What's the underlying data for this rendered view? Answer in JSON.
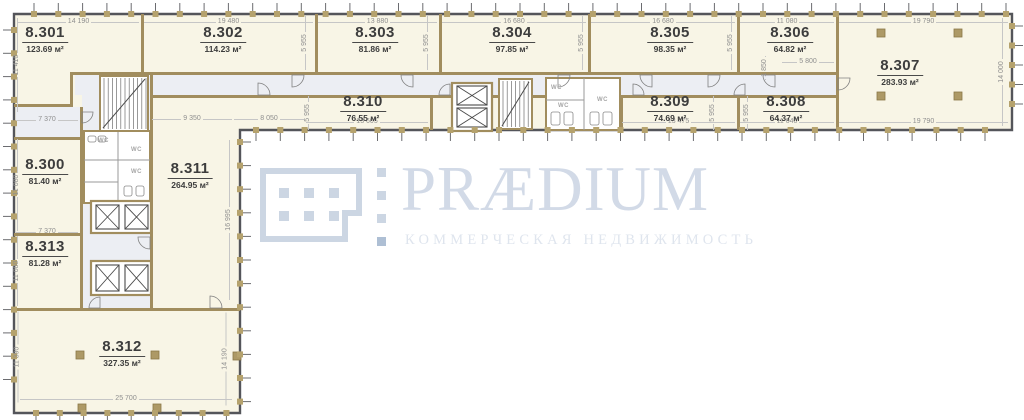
{
  "brand": {
    "name": "PRÆDIUM",
    "tagline": "КОММЕРЧЕСКАЯ НЕДВИЖИМОСТЬ"
  },
  "colors": {
    "room_fill": "#f8f5e6",
    "corridor_fill": "#eceef3",
    "wall": "#a18d5e",
    "tick_mark": "#b5a26d",
    "outline": "#54555a",
    "dim_text": "#8f8f8f",
    "label_text": "#3d3d3d",
    "wm_main": "#ccd6e3",
    "wm_text": "#d2dae7",
    "wm_sub": "#dfe5ee",
    "wm_accent": "#aebfd4"
  },
  "plan": {
    "unit": "м²",
    "wc_label": "WC",
    "rooms": [
      {
        "code": "8.301",
        "area": "123.69",
        "cx": 45,
        "cy": 24
      },
      {
        "code": "8.302",
        "area": "114.23",
        "cx": 223,
        "cy": 24
      },
      {
        "code": "8.303",
        "area": "81.86",
        "cx": 375,
        "cy": 24
      },
      {
        "code": "8.304",
        "area": "97.85",
        "cx": 512,
        "cy": 24
      },
      {
        "code": "8.305",
        "area": "98.35",
        "cx": 670,
        "cy": 24
      },
      {
        "code": "8.306",
        "area": "64.82",
        "cx": 790,
        "cy": 24
      },
      {
        "code": "8.307",
        "area": "283.93",
        "cx": 900,
        "cy": 57
      },
      {
        "code": "8.310",
        "area": "76.55",
        "cx": 363,
        "cy": 93
      },
      {
        "code": "8.309",
        "area": "74.69",
        "cx": 670,
        "cy": 93
      },
      {
        "code": "8.308",
        "area": "64.37",
        "cx": 786,
        "cy": 93
      },
      {
        "code": "8.300",
        "area": "81.40",
        "cx": 45,
        "cy": 156
      },
      {
        "code": "8.311",
        "area": "264.95",
        "cx": 190,
        "cy": 160
      },
      {
        "code": "8.313",
        "area": "81.28",
        "cx": 45,
        "cy": 238
      },
      {
        "code": "8.312",
        "area": "327.35",
        "cx": 122,
        "cy": 338
      }
    ],
    "dims_h": [
      {
        "t": "14 190",
        "x1": 18,
        "x2": 139,
        "y": 17
      },
      {
        "t": "19 480",
        "x1": 144,
        "x2": 313,
        "y": 17
      },
      {
        "t": "13 880",
        "x1": 318,
        "x2": 437,
        "y": 17
      },
      {
        "t": "16 680",
        "x1": 442,
        "x2": 586,
        "y": 17
      },
      {
        "t": "16 680",
        "x1": 591,
        "x2": 735,
        "y": 17
      },
      {
        "t": "11 080",
        "x1": 740,
        "x2": 834,
        "y": 17
      },
      {
        "t": "19 790",
        "x1": 839,
        "x2": 1008,
        "y": 17
      },
      {
        "t": "19 790",
        "x1": 839,
        "x2": 1008,
        "y": 117
      },
      {
        "t": "11 040",
        "x1": 740,
        "x2": 834,
        "y": 117
      },
      {
        "t": "13 475",
        "x1": 622,
        "x2": 735,
        "y": 117
      },
      {
        "t": "13 605",
        "x1": 306,
        "x2": 428,
        "y": 117
      },
      {
        "t": "8 050",
        "x1": 234,
        "x2": 304,
        "y": 114
      },
      {
        "t": "9 350",
        "x1": 152,
        "x2": 232,
        "y": 114
      },
      {
        "t": "5 800",
        "x1": 782,
        "x2": 834,
        "y": 57
      },
      {
        "t": "7 370",
        "x1": 16,
        "x2": 78,
        "y": 115
      },
      {
        "t": "7 370",
        "x1": 16,
        "x2": 78,
        "y": 227
      },
      {
        "t": "25 700",
        "x1": 20,
        "x2": 232,
        "y": 394
      }
    ],
    "dims_v": [
      {
        "t": "11 410",
        "x": 17,
        "y1": 18,
        "y2": 112
      },
      {
        "t": "11 080",
        "x": 17,
        "y1": 139,
        "y2": 231
      },
      {
        "t": "11 080",
        "x": 17,
        "y1": 236,
        "y2": 306
      },
      {
        "t": "11 390",
        "x": 17,
        "y1": 311,
        "y2": 402
      },
      {
        "t": "14 000",
        "x": 1002,
        "y1": 18,
        "y2": 126
      },
      {
        "t": "16 995",
        "x": 229,
        "y1": 140,
        "y2": 300
      },
      {
        "t": "14 190",
        "x": 225,
        "y1": 312,
        "y2": 405
      },
      {
        "t": "1 850",
        "x": 765,
        "y1": 56,
        "y2": 80
      },
      {
        "t": "5 955",
        "x": 305,
        "y1": 16,
        "y2": 70
      },
      {
        "t": "5 955",
        "x": 427,
        "y1": 16,
        "y2": 70
      },
      {
        "t": "5 955",
        "x": 582,
        "y1": 16,
        "y2": 70
      },
      {
        "t": "5 955",
        "x": 731,
        "y1": 16,
        "y2": 70
      },
      {
        "t": "5 955",
        "x": 308,
        "y1": 96,
        "y2": 130
      },
      {
        "t": "5 955",
        "x": 713,
        "y1": 96,
        "y2": 130
      },
      {
        "t": "5 955",
        "x": 747,
        "y1": 96,
        "y2": 130
      }
    ],
    "wc_labels": [
      {
        "x": 98,
        "y": 138
      },
      {
        "x": 131,
        "y": 147
      },
      {
        "x": 131,
        "y": 169
      },
      {
        "x": 551,
        "y": 85
      },
      {
        "x": 558,
        "y": 103
      },
      {
        "x": 597,
        "y": 97
      }
    ],
    "outline_path": "M14,14 H1012 V130 H240 V413 H14 Z",
    "corridors": [
      [
        75,
        75,
        761,
        20
      ],
      [
        82,
        72,
        70,
        238
      ],
      [
        16,
        107,
        66,
        30
      ]
    ],
    "walls": [
      [
        141,
        14,
        3,
        58
      ],
      [
        315,
        14,
        3,
        58
      ],
      [
        439,
        14,
        3,
        58
      ],
      [
        588,
        14,
        3,
        58
      ],
      [
        737,
        14,
        3,
        58
      ],
      [
        836,
        14,
        3,
        116
      ],
      [
        430,
        95,
        3,
        35
      ],
      [
        545,
        95,
        3,
        35
      ],
      [
        620,
        95,
        3,
        35
      ],
      [
        737,
        95,
        3,
        35
      ],
      [
        73,
        72,
        763,
        3
      ],
      [
        150,
        95,
        686,
        3
      ],
      [
        14,
        104,
        59,
        3
      ],
      [
        70,
        72,
        3,
        35
      ],
      [
        80,
        107,
        3,
        203
      ],
      [
        150,
        72,
        3,
        238
      ],
      [
        14,
        137,
        68,
        3
      ],
      [
        14,
        233,
        68,
        3
      ],
      [
        14,
        308,
        226,
        3
      ]
    ],
    "cores": [
      [
        546,
        78,
        74,
        52
      ],
      [
        84,
        131,
        66,
        72
      ]
    ],
    "stairs": [
      [
        100,
        76,
        48,
        55
      ],
      [
        499,
        79,
        33,
        50
      ]
    ],
    "elev_frames": [
      [
        91,
        201,
        60,
        32
      ],
      [
        91,
        261,
        60,
        34
      ],
      [
        452,
        83,
        40,
        48
      ]
    ],
    "elev_cabs": [
      [
        96,
        205,
        23,
        24
      ],
      [
        125,
        205,
        23,
        24
      ],
      [
        96,
        265,
        23,
        26
      ],
      [
        125,
        265,
        23,
        26
      ],
      [
        457,
        86,
        30,
        19
      ],
      [
        457,
        108,
        30,
        19
      ]
    ],
    "partitions": [
      [
        84,
        160,
        150,
        160
      ],
      [
        84,
        182,
        118,
        182
      ],
      [
        118,
        131,
        118,
        203
      ],
      [
        584,
        78,
        584,
        130
      ],
      [
        546,
        100,
        584,
        100
      ]
    ],
    "fixtures": [
      [
        551,
        112,
        9,
        13
      ],
      [
        564,
        112,
        9,
        13
      ],
      [
        590,
        112,
        9,
        13
      ],
      [
        603,
        112,
        9,
        13
      ],
      [
        88,
        136,
        8,
        6
      ],
      [
        98,
        136,
        8,
        6
      ],
      [
        124,
        186,
        8,
        10
      ],
      [
        136,
        186,
        8,
        10
      ]
    ],
    "doors": [
      [
        292,
        75,
        12,
        0,
        90
      ],
      [
        413,
        75,
        12,
        90,
        180
      ],
      [
        558,
        75,
        12,
        0,
        90
      ],
      [
        652,
        75,
        12,
        90,
        180
      ],
      [
        708,
        75,
        12,
        0,
        90
      ],
      [
        775,
        75,
        12,
        90,
        180
      ],
      [
        838,
        78,
        12,
        0,
        90
      ],
      [
        258,
        95,
        12,
        270,
        360
      ],
      [
        450,
        95,
        11,
        180,
        270
      ],
      [
        633,
        95,
        11,
        270,
        360
      ],
      [
        745,
        95,
        11,
        180,
        270
      ],
      [
        82,
        112,
        11,
        0,
        90
      ],
      [
        150,
        237,
        12,
        90,
        180
      ],
      [
        100,
        308,
        11,
        180,
        270
      ],
      [
        210,
        308,
        12,
        270,
        360
      ]
    ],
    "columns": [
      [
        877,
        29,
        8,
        8
      ],
      [
        954,
        29,
        8,
        8
      ],
      [
        877,
        92,
        8,
        8
      ],
      [
        954,
        92,
        8,
        8
      ],
      [
        76,
        351,
        8,
        8
      ],
      [
        151,
        351,
        8,
        8
      ],
      [
        78,
        404,
        8,
        8
      ],
      [
        153,
        404,
        8,
        8
      ],
      [
        233,
        352,
        8,
        8
      ]
    ],
    "ticks": [
      {
        "dir": "top",
        "from": 34,
        "to": 1006,
        "step": 24.3,
        "pos": 14
      },
      {
        "dir": "bottom",
        "from": 256,
        "to": 1006,
        "step": 24.3,
        "pos": 130
      },
      {
        "dir": "bottom",
        "from": 36,
        "to": 228,
        "step": 23.8,
        "pos": 413
      },
      {
        "dir": "left",
        "from": 30,
        "to": 402,
        "step": 23.3,
        "pos": 14
      },
      {
        "dir": "right",
        "from": 26,
        "to": 122,
        "step": 19.5,
        "pos": 1012
      },
      {
        "dir": "right",
        "from": 142,
        "to": 402,
        "step": 23.6,
        "pos": 240
      }
    ]
  }
}
